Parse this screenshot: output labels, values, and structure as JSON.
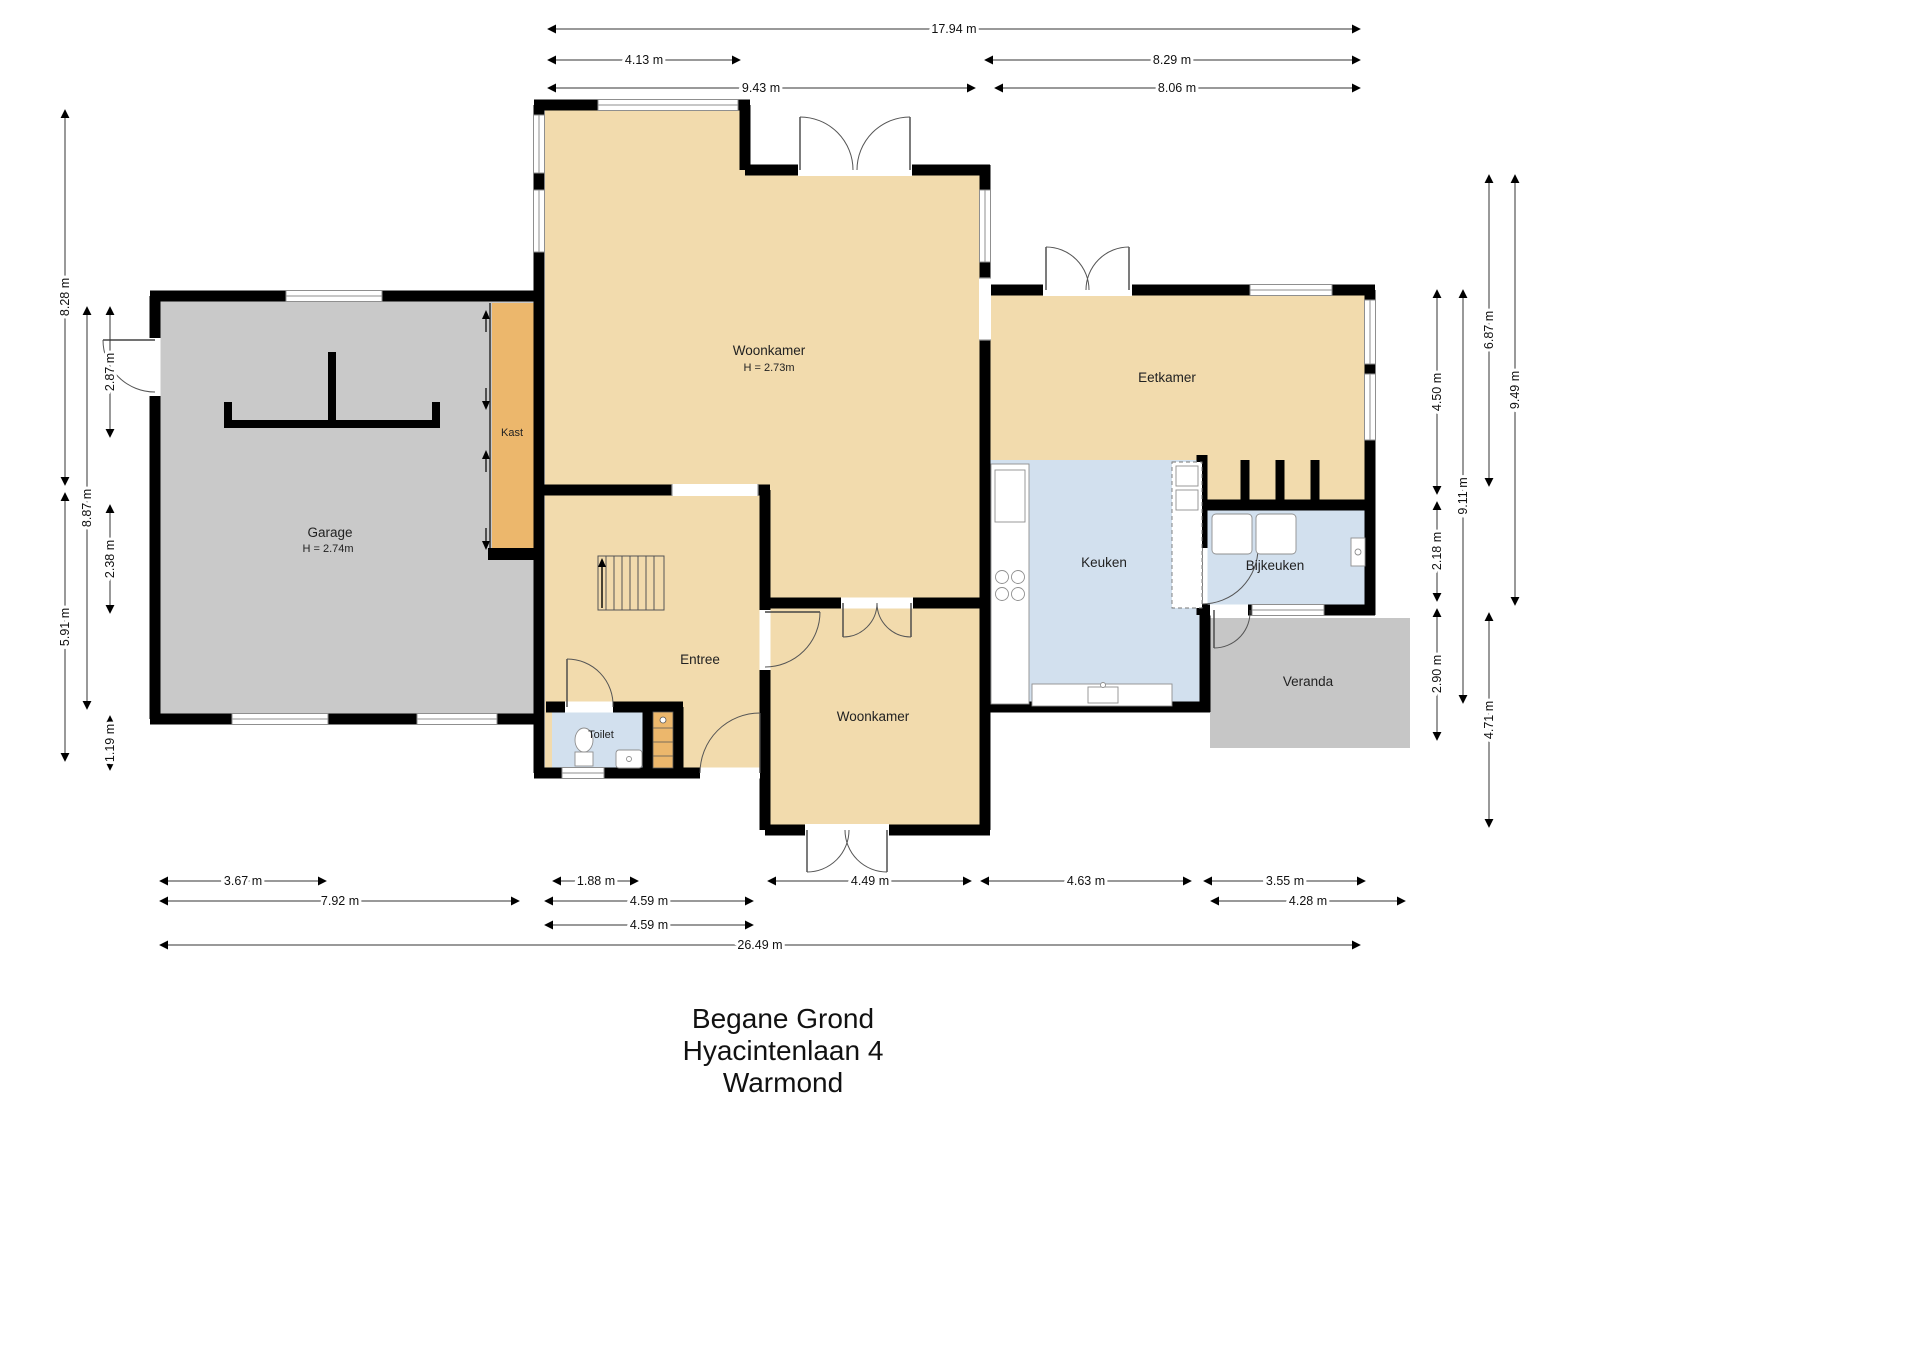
{
  "title": {
    "line1": "Begane Grond",
    "line2": "Hyacintenlaan 4",
    "line3": "Warmond"
  },
  "colors": {
    "room_beige": "#f2dbad",
    "garage_gray": "#c9c9c9",
    "room_blue": "#d2e0ee",
    "kast_orange": "#ecb76c",
    "veranda_gray": "#c6c6c6",
    "wall_black": "#000000"
  },
  "rooms": {
    "woonkamer1": {
      "label": "Woonkamer",
      "height": "H = 2.73m"
    },
    "garage": {
      "label": "Garage",
      "height": "H = 2.74m"
    },
    "kast": {
      "label": "Kast"
    },
    "eetkamer": {
      "label": "Eetkamer"
    },
    "keuken": {
      "label": "Keuken"
    },
    "bijkeuken": {
      "label": "Bijkeuken"
    },
    "veranda": {
      "label": "Veranda"
    },
    "entree": {
      "label": "Entree"
    },
    "toilet": {
      "label": "Toilet"
    },
    "woonkamer2": {
      "label": "Woonkamer"
    }
  },
  "dimensions": {
    "top": {
      "d1794": "17.94 m",
      "d413": "4.13 m",
      "d829": "8.29 m",
      "d943": "9.43 m",
      "d806": "8.06 m"
    },
    "bottom": {
      "d367": "3.67 m",
      "d792": "7.92 m",
      "d188": "1.88 m",
      "d459a": "4.59 m",
      "d459b": "4.59 m",
      "d449": "4.49 m",
      "d463": "4.63 m",
      "d355": "3.55 m",
      "d428": "4.28 m",
      "d2649": "26.49 m"
    },
    "left": {
      "d828": "8.28 m",
      "d591": "5.91 m",
      "d887": "8.87 m",
      "d287": "2.87 m",
      "d238": "2.38 m",
      "d119": "1.19 m"
    },
    "right": {
      "d450": "4.50 m",
      "d218": "2.18 m",
      "d290": "2.90 m",
      "d911": "9.11 m",
      "d687": "6.87 m",
      "d471": "4.71 m",
      "d949": "9.49 m"
    }
  }
}
